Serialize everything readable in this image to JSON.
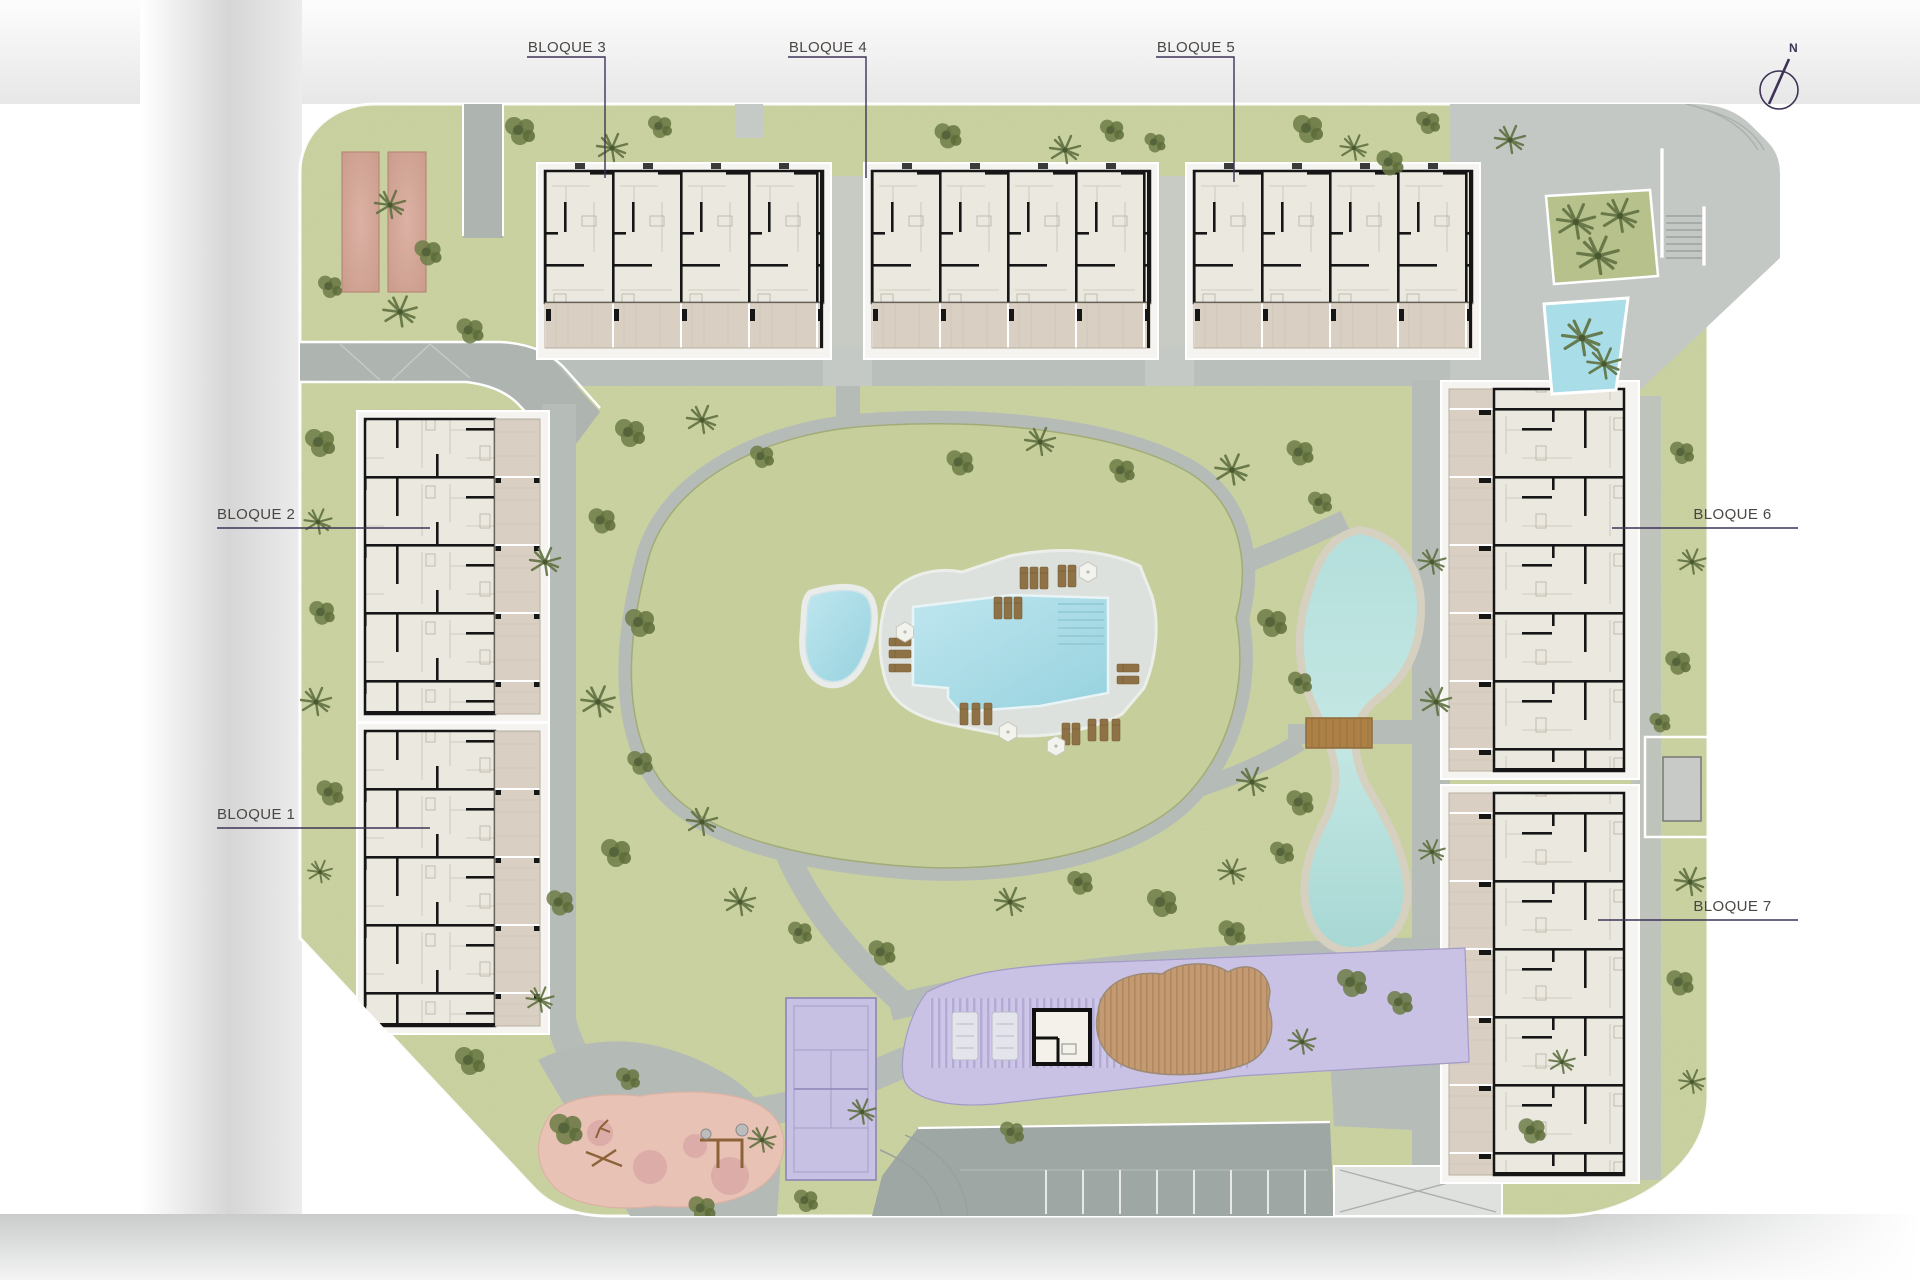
{
  "blocks": [
    {
      "id": "bloque-1",
      "label": "BLOQUE 1"
    },
    {
      "id": "bloque-2",
      "label": "BLOQUE 2"
    },
    {
      "id": "bloque-3",
      "label": "BLOQUE 3"
    },
    {
      "id": "bloque-4",
      "label": "BLOQUE 4"
    },
    {
      "id": "bloque-5",
      "label": "BLOQUE 5"
    },
    {
      "id": "bloque-6",
      "label": "BLOQUE 6"
    },
    {
      "id": "bloque-7",
      "label": "BLOQUE 7"
    }
  ],
  "compass": {
    "north_label": "N"
  },
  "colors": {
    "lawn": "#cbd3a2",
    "mound_lawn": "#c6cf9b",
    "path_gray": "#b6bcb8",
    "parking_gray": "#9ea7a4",
    "pool_water": "#a9dce8",
    "lake_water": "#b7dedb",
    "building_floor": "#ebe8e0",
    "building_wall": "#161616",
    "terrace_tan": "#d9d0c3",
    "court_purple": "#c7c1e3",
    "pergola_purple": "#c9c2e4",
    "wood_deck": "#c49a72",
    "playground_pink": "#e8c2b4",
    "petanque_salmon": "#d3a294",
    "label_ink": "#4a4643",
    "leader_line": "#3e3357"
  }
}
